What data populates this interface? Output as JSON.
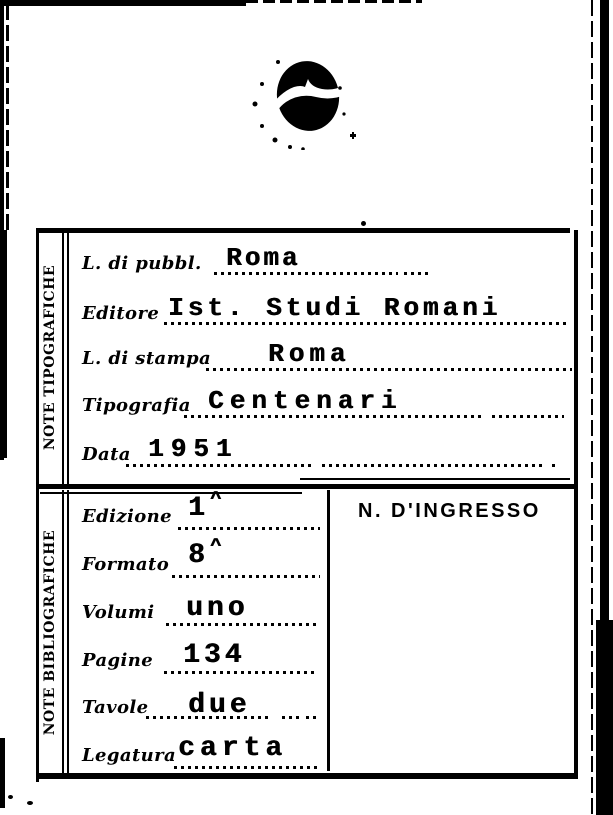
{
  "colors": {
    "ink": "#000000",
    "paper": "#ffffff"
  },
  "card": {
    "typographic": {
      "header": "NOTE TIPOGRAFICHE",
      "fields": [
        {
          "label": "L. di pubbl.",
          "value": "Roma"
        },
        {
          "label": "Editore",
          "value": "Ist. Studi Romani"
        },
        {
          "label": "L. di stampa",
          "value": "Roma"
        },
        {
          "label": "Tipografia",
          "value": "Centenari"
        },
        {
          "label": "Data",
          "value": "1951"
        }
      ]
    },
    "bibliographic": {
      "header": "NOTE BIBLIOGRAFICHE",
      "ingresso_label": "N. D'INGRESSO",
      "fields": [
        {
          "label": "Edizione",
          "value": "1",
          "sup": "^"
        },
        {
          "label": "Formato",
          "value": "8",
          "sup": "^"
        },
        {
          "label": "Volumi",
          "value": "uno"
        },
        {
          "label": "Pagine",
          "value": "134"
        },
        {
          "label": "Tavole",
          "value": "due"
        },
        {
          "label": "Legatura",
          "value": "carta"
        }
      ]
    }
  }
}
